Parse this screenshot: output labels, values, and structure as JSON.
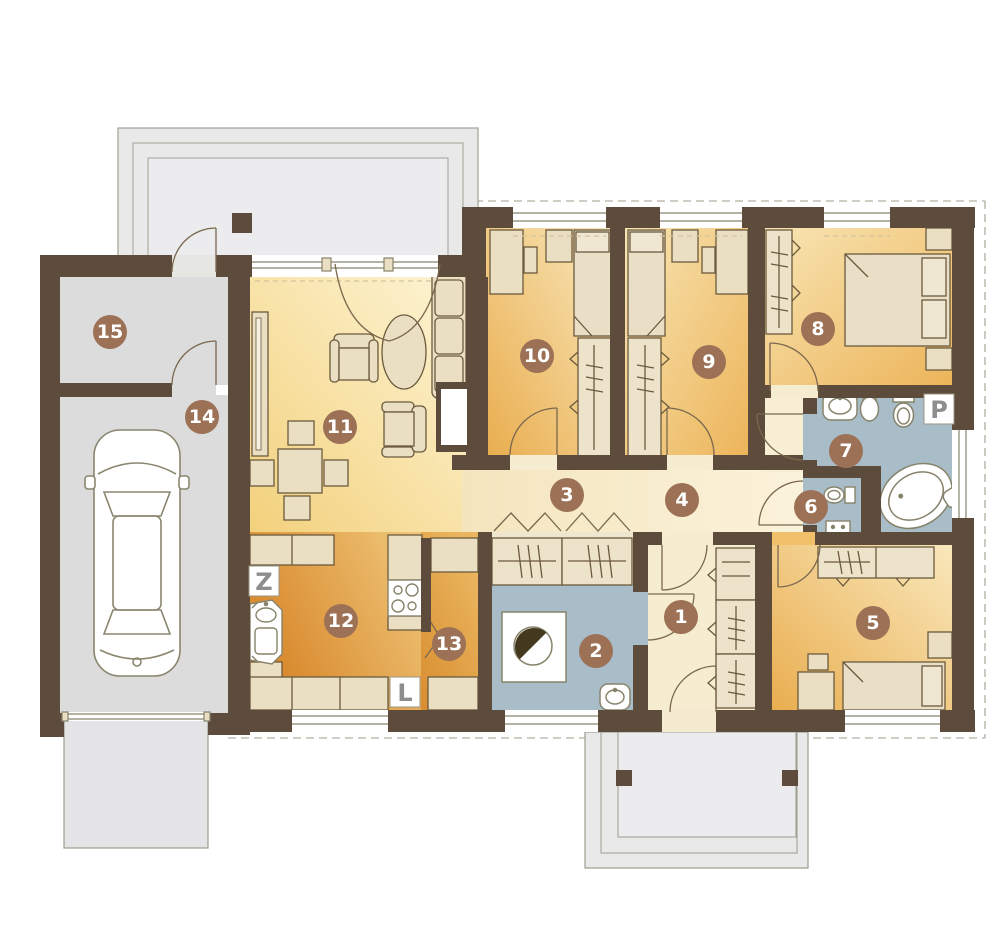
{
  "plan_title": "Single-storey house floor plan with garage",
  "palette": {
    "wall": "#5d4b3b",
    "badge": "#9c7156",
    "badge_text": "#ffffff",
    "letter": "#8d8d8d",
    "bath_floor": "#a9bdc9",
    "bedroom_floor_dark": "#e9ad4e",
    "bedroom_floor_light": "#f9e8bc",
    "living_floor_dark": "#f3d17c",
    "living_floor_light": "#fdf5d7",
    "kitchen_floor_dark": "#d8872a",
    "kitchen_floor_light": "#f0c87c",
    "hall_floor": "#f6ecd0",
    "indoor_gray": "#dcdcdd",
    "outdoor_gray": "#e9e9ea",
    "furniture": "#eadfc2"
  },
  "room_badges": [
    {
      "number": "1",
      "x": 681,
      "y": 617
    },
    {
      "number": "2",
      "x": 596,
      "y": 651
    },
    {
      "number": "3",
      "x": 567,
      "y": 495
    },
    {
      "number": "4",
      "x": 682,
      "y": 500
    },
    {
      "number": "5",
      "x": 873,
      "y": 623
    },
    {
      "number": "6",
      "x": 811,
      "y": 507
    },
    {
      "number": "7",
      "x": 846,
      "y": 451
    },
    {
      "number": "8",
      "x": 818,
      "y": 329
    },
    {
      "number": "9",
      "x": 709,
      "y": 362
    },
    {
      "number": "10",
      "x": 537,
      "y": 356
    },
    {
      "number": "11",
      "x": 340,
      "y": 427
    },
    {
      "number": "12",
      "x": 341,
      "y": 621
    },
    {
      "number": "13",
      "x": 449,
      "y": 644
    },
    {
      "number": "14",
      "x": 202,
      "y": 417
    },
    {
      "number": "15",
      "x": 110,
      "y": 332
    }
  ],
  "letter_markers": [
    {
      "letter": "Z",
      "x": 264,
      "y": 581
    },
    {
      "letter": "L",
      "x": 405,
      "y": 692
    },
    {
      "letter": "P",
      "x": 939,
      "y": 409
    }
  ]
}
